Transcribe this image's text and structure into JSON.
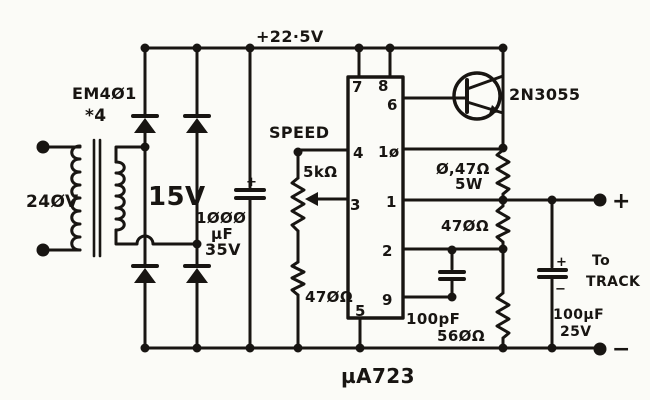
{
  "colors": {
    "ink": "#181512",
    "paper": "#fbfbf7"
  },
  "schematic": {
    "labels": {
      "supply_rail": "+22·5V",
      "rectifier_type": "EM4Ø1",
      "rectifier_qty": "*4",
      "mains_voltage": "24ØV",
      "secondary_voltage": "15V",
      "filter_cap_value": "1ØØØ",
      "filter_cap_unit": "µF",
      "filter_cap_voltage": "35V",
      "speed": "SPEED",
      "pot_value": "5kΩ",
      "speed_resistor": "47ØΩ",
      "emitter_resistor": "Ø,47Ω",
      "emitter_resistor_power": "5W",
      "feedback_resistor": "47ØΩ",
      "comp_cap": "100pF",
      "divider_resistor": "56ØΩ",
      "transistor": "2N3055",
      "ic": "µA723",
      "output_cap_value": "100µF",
      "output_cap_voltage": "25V",
      "dest_line1": "To",
      "dest_line2": "TRACK",
      "plus_terminal": "+",
      "minus_terminal": "−",
      "filter_cap_plus": "+",
      "output_cap_plus": "+",
      "output_cap_minus": "−"
    },
    "ic_pins": {
      "p7": "7",
      "p8": "8",
      "p6": "6",
      "p4": "4",
      "p10": "1ø",
      "p3": "3",
      "p1": "1",
      "p2": "2",
      "p9": "9",
      "p5": "5"
    }
  }
}
